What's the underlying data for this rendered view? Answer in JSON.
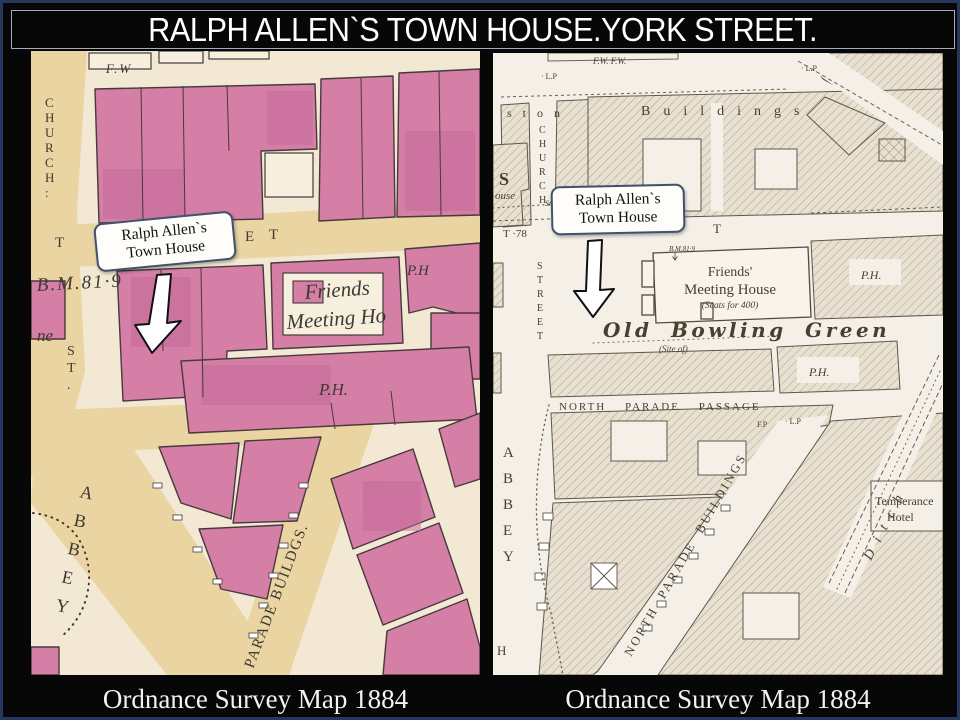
{
  "slide": {
    "title": "RALPH ALLEN`S TOWN HOUSE.YORK STREET.",
    "frame_color": "#26365c",
    "background_color": "#070707",
    "title_color": "#ffffff"
  },
  "left_map": {
    "caption": "Ordnance Survey Map 1884",
    "callout": {
      "line1": "Ralph Allen`s",
      "line2": "Town House"
    },
    "colors": {
      "paper": "#f2e8d3",
      "road": "#e9d4a2",
      "building": "#d57ea6",
      "building_dark": "#c4679a",
      "ink": "#3f3833"
    },
    "labels": {
      "fw": "F.W",
      "church": "CHURCH:",
      "t1": "T",
      "e": "E",
      "t2": "T",
      "bm": "B.M.81·9",
      "ne": "ne",
      "st": "ST.",
      "friends": "Friends",
      "meeting": "Meeting Ho",
      "ph_top": "P.H",
      "ph_mid": "P.H.",
      "abbey": "ABBEY",
      "parade": "PARADE BUILDGS."
    }
  },
  "right_map": {
    "caption": "Ordnance Survey Map 1884",
    "callout": {
      "line1": "Ralph Allen`s",
      "line2": "Town House"
    },
    "colors": {
      "paper": "#f4f0e7",
      "hatch": "#b3a48e",
      "ink": "#473f30"
    },
    "labels": {
      "fw": "F.W. F.W.",
      "lp1": "· L.P",
      "lp2": "· L.P",
      "ston": "ston",
      "buildings": "Buildings",
      "church": "CHURCH",
      "s": "S",
      "ouse": "ouse",
      "stones": "Stones",
      "t78": "T ·78",
      "e": "E",
      "t": "T",
      "street": "STREET",
      "bm": "B.M.81·9",
      "fmh1": "Friends'",
      "fmh2": "Meeting House",
      "fmh3": "(Seats for 400)",
      "obg": "Old Bowling Green",
      "site_of": "(Site of)",
      "ph_top": "P.H.",
      "ph_mid": "P.H.",
      "npp": "NORTH PARADE PASSAGE",
      "fp": "F.P",
      "lp3": "· L.P",
      "npb": "NORTH PARADE BUILDINGS",
      "abbey": "ABBEY",
      "h": "H",
      "ditch": "Ditch",
      "hotel1": "Temperance",
      "hotel2": "Hotel"
    }
  }
}
